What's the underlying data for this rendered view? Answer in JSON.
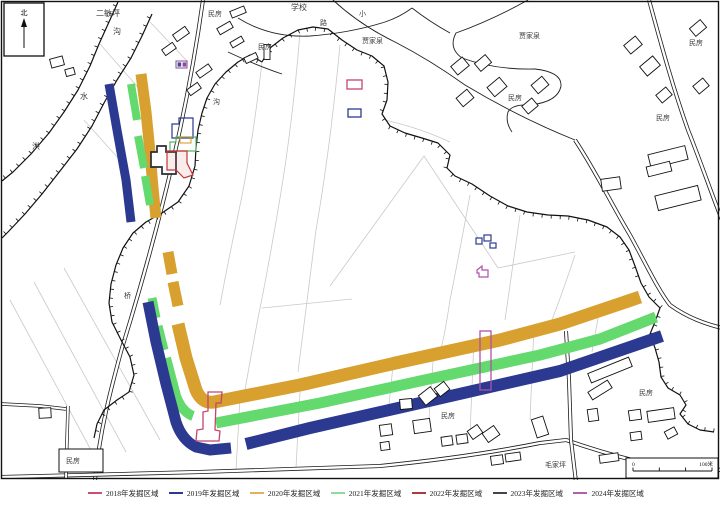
{
  "map": {
    "colors": {
      "y2018": "#c2456e",
      "y2019": "#2b3990",
      "y2020": "#d8a02e",
      "y2021": "#63d96e",
      "y2022": "#c03636",
      "y2023": "#2a2a32",
      "y2024": "#b050a8",
      "road": "#1a1a1a",
      "field": "#c9c9c9",
      "terrain": "#111111"
    },
    "labels": [
      {
        "text": "二敏坪",
        "x": 96,
        "y": 8,
        "s": 8
      },
      {
        "text": "民房",
        "x": 208,
        "y": 9,
        "s": 7
      },
      {
        "text": "学校",
        "x": 291,
        "y": 2,
        "s": 8
      },
      {
        "text": "小",
        "x": 359,
        "y": 9,
        "s": 7
      },
      {
        "text": "路",
        "x": 320,
        "y": 18,
        "s": 7
      },
      {
        "text": "贾家泉",
        "x": 362,
        "y": 36,
        "s": 7
      },
      {
        "text": "民房",
        "x": 258,
        "y": 42,
        "s": 7
      },
      {
        "text": "贾家泉",
        "x": 519,
        "y": 31,
        "s": 7
      },
      {
        "text": "民房",
        "x": 689,
        "y": 38,
        "s": 7
      },
      {
        "text": "民房",
        "x": 508,
        "y": 93,
        "s": 7
      },
      {
        "text": "民房",
        "x": 656,
        "y": 113,
        "s": 7
      },
      {
        "text": "沟",
        "x": 113,
        "y": 26,
        "s": 8
      },
      {
        "text": "水",
        "x": 80,
        "y": 91,
        "s": 8
      },
      {
        "text": "洪",
        "x": 32,
        "y": 141,
        "s": 8
      },
      {
        "text": "沟",
        "x": 213,
        "y": 97,
        "s": 7
      },
      {
        "text": "桥",
        "x": 124,
        "y": 291,
        "s": 7
      },
      {
        "text": "民房",
        "x": 441,
        "y": 411,
        "s": 7
      },
      {
        "text": "民房",
        "x": 639,
        "y": 388,
        "s": 7
      },
      {
        "text": "毛家坪",
        "x": 545,
        "y": 460,
        "s": 7
      },
      {
        "text": "民房",
        "x": 66,
        "y": 456,
        "s": 7
      }
    ],
    "north_label": "北",
    "scale": {
      "left": "0",
      "right": "100米"
    }
  },
  "legend": {
    "items": [
      {
        "label": "2018年发掘区域",
        "color": "#c9506f"
      },
      {
        "label": "2019年发掘区域",
        "color": "#2b3990"
      },
      {
        "label": "2020年发掘区域",
        "color": "#e2b05e"
      },
      {
        "label": "2021年发掘区域",
        "color": "#8fdc96"
      },
      {
        "label": "2022年发掘区域",
        "color": "#a93b3b"
      },
      {
        "label": "2023年发掘区域",
        "color": "#44444c"
      },
      {
        "label": "2024年发掘区域",
        "color": "#b161a8"
      }
    ]
  }
}
